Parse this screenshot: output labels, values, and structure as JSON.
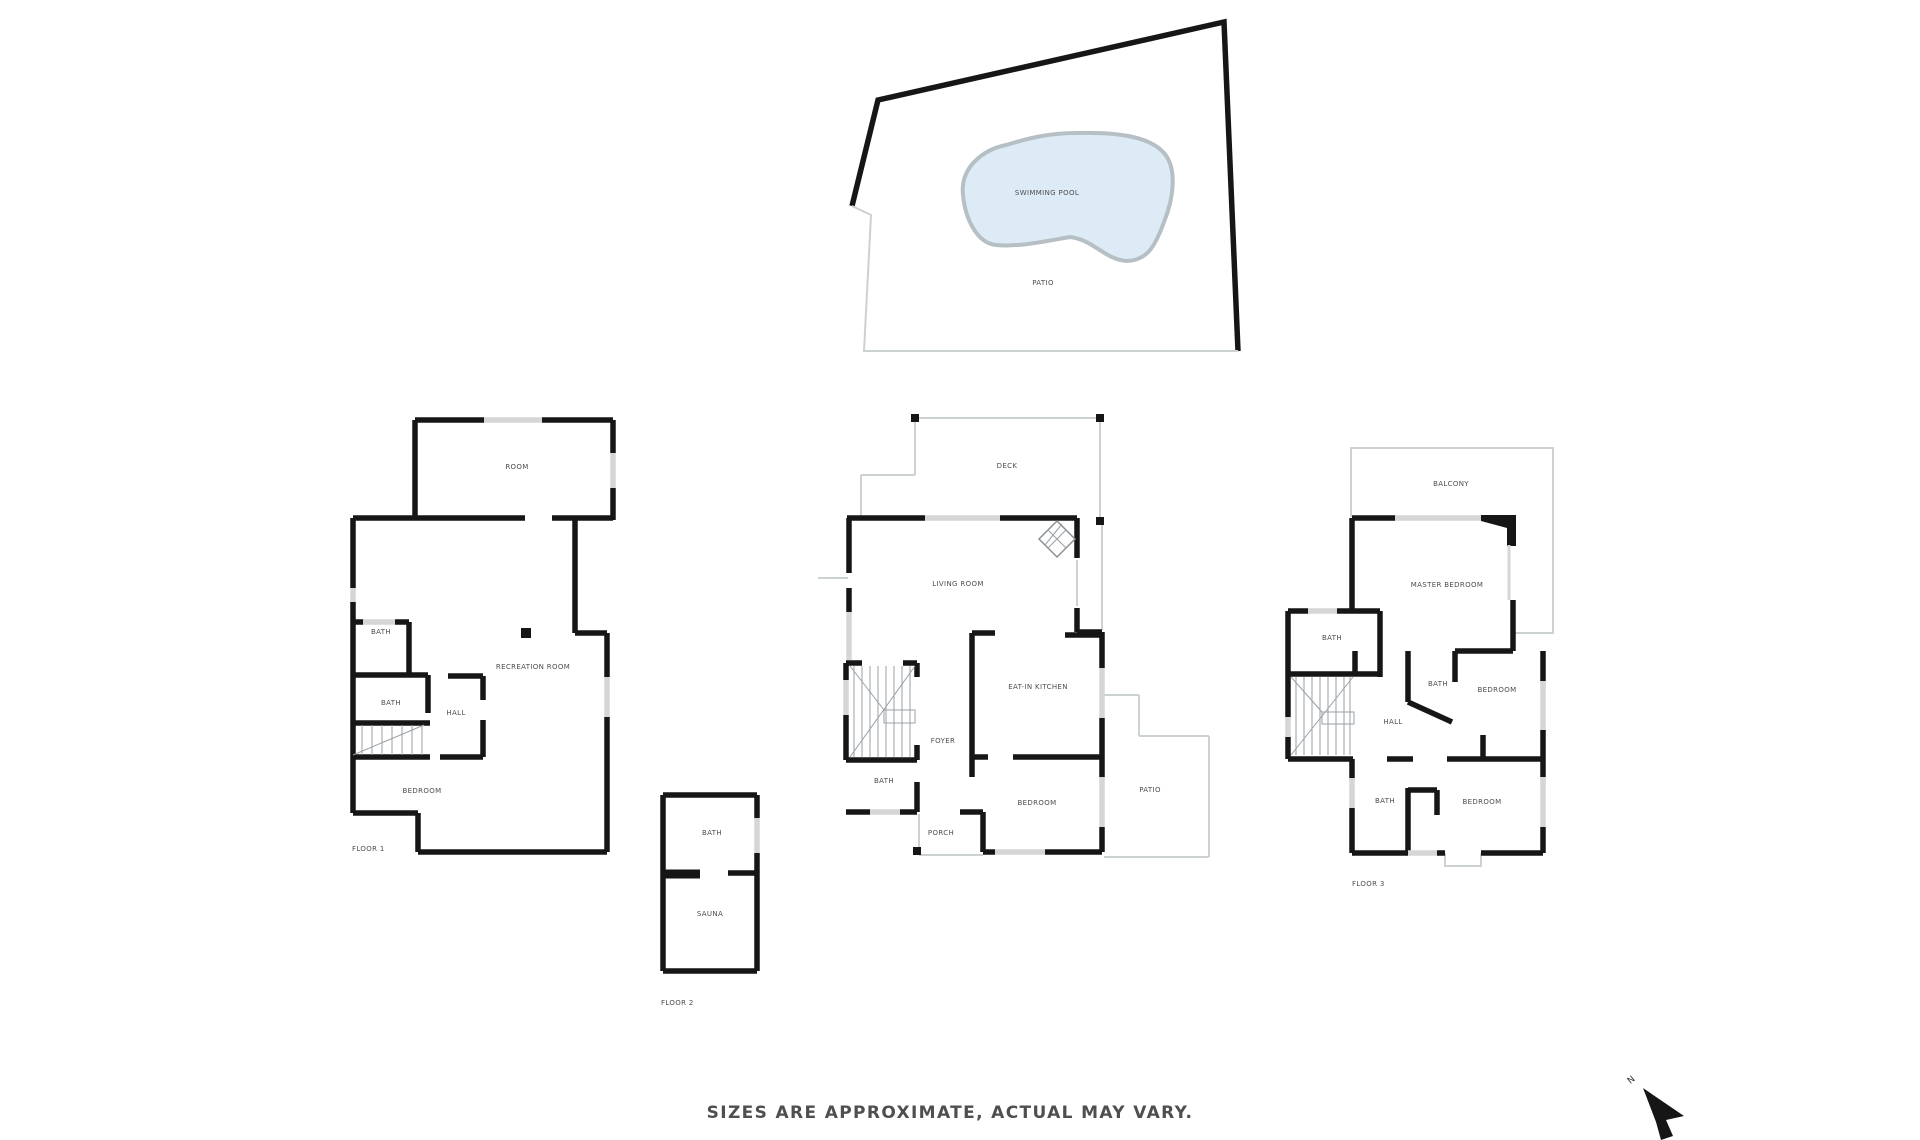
{
  "site": {
    "pool_label": "SWIMMING POOL",
    "patio_label": "PATIO"
  },
  "floor1": {
    "room": "ROOM",
    "bath_upper": "BATH",
    "bath_lower": "BATH",
    "hall": "HALL",
    "recreation_room": "RECREATION ROOM",
    "bedroom": "BEDROOM",
    "caption": "FLOOR 1"
  },
  "floor2": {
    "bath": "BATH",
    "sauna": "SAUNA",
    "caption": "FLOOR 2"
  },
  "main_floor": {
    "deck": "DECK",
    "living_room": "LIVING ROOM",
    "eat_in_kitchen": "EAT-IN KITCHEN",
    "foyer": "FOYER",
    "bath": "BATH",
    "bedroom": "BEDROOM",
    "porch": "PORCH",
    "patio": "PATIO"
  },
  "floor3": {
    "balcony": "BALCONY",
    "master_bedroom": "MASTER BEDROOM",
    "bath_upper_left": "BATH",
    "bath_middle": "BATH",
    "bath_lower": "BATH",
    "hall": "HALL",
    "bedroom_upper": "BEDROOM",
    "bedroom_lower": "BEDROOM",
    "caption": "FLOOR 3"
  },
  "footer": {
    "disclaimer": "SIZES ARE APPROXIMATE, ACTUAL MAY VARY."
  },
  "compass": {
    "north_label": "N"
  },
  "colors": {
    "wall": "#161616",
    "window": "#d6d6d6",
    "thin_line": "#ccd1d4",
    "hatch": "#9aa0a4",
    "label_text": "#4d4d4d",
    "pool_fill": "#dcebf6",
    "pool_stroke": "#b5bfc4"
  }
}
